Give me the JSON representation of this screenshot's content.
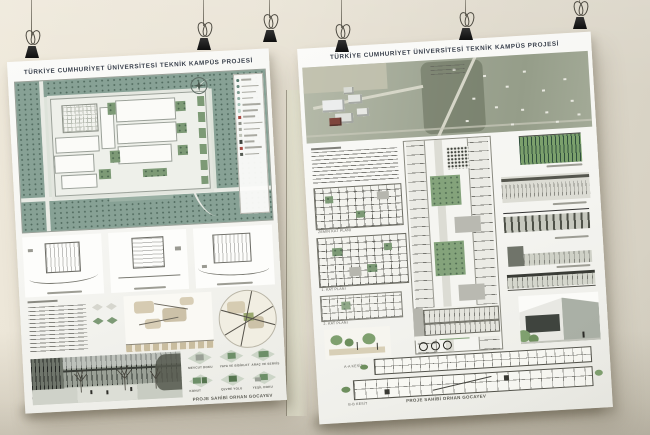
{
  "left_poster": {
    "title": "TÜRKİYE CUMHURİYET ÜNİVERSİTESİ TEKNİK KAMPÜS PROJESİ",
    "credit": "PROJE SAHİBİ ORHAN GOCAYEV",
    "massing_labels": [
      "MEVCUT DOKU",
      "YAYA VE BİSİKLET",
      "ARAÇ VE SERVİS",
      "KONUT",
      "ÇEVRE YOLU",
      "YEŞİL DOKU"
    ]
  },
  "right_poster": {
    "title": "TÜRKİYE CUMHURİYET ÜNİVERSİTESİ TEKNİK KAMPÜS PROJESİ",
    "credit": "PROJE SAHİBİ ORHAN GOCAYEV",
    "plan_labels": [
      "ZEMİN KAT PLANI",
      "1. KAT PLANI",
      "2. KAT PLANI"
    ],
    "section_labels": [
      "A-A KESİT",
      "B-B KESİT"
    ]
  },
  "palette": {
    "wall": "#e7e1d3",
    "paper": "#f6f6f3",
    "site_green": "#87a195",
    "courtyard_green": "#7d9a76",
    "legend_icon_colors": [
      "#55796d",
      "#68897d",
      "#7c9c90",
      "#90afa3",
      "#a4c2b6",
      "#b8d2c7",
      "#a84b42",
      "#8a8e85",
      "#a2a69c",
      "#c0c4b9",
      "#3f443e",
      "#a84b42",
      "#565b53"
    ]
  }
}
